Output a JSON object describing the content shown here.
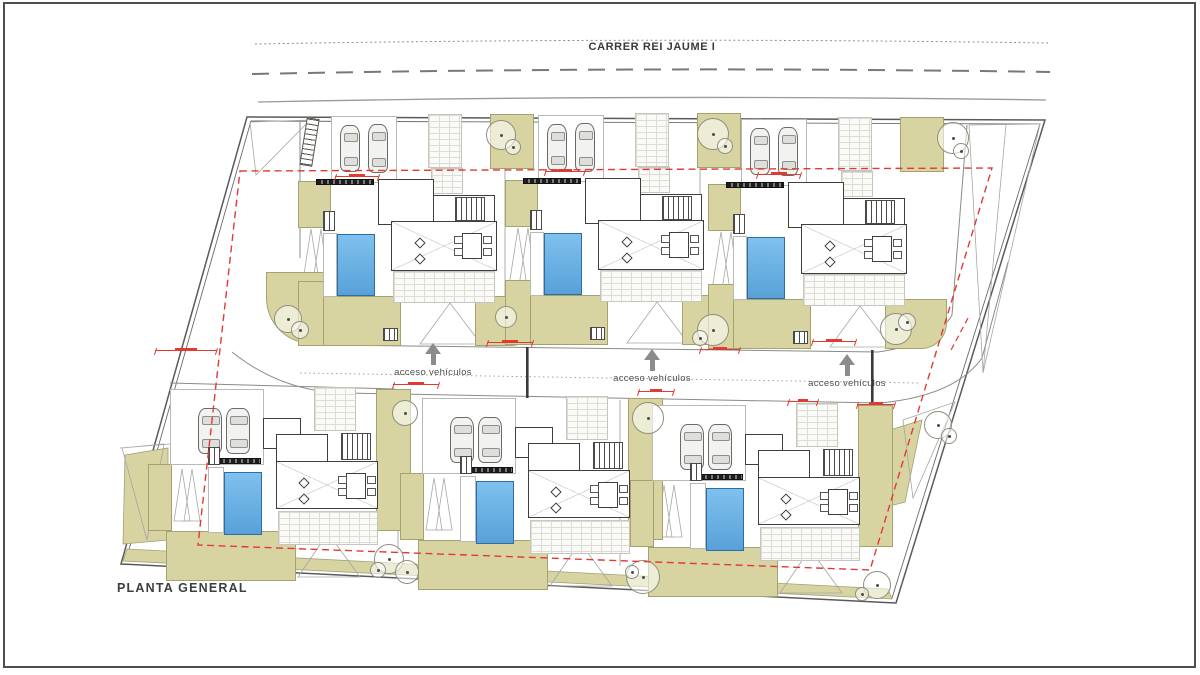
{
  "title_block": {
    "street_name": "CARRER REI JAUME I",
    "plan_title": "PLANTA GENERAL"
  },
  "road": {
    "access_label": "acceso vehículos",
    "arrows": [
      {
        "x": 433,
        "y": 343
      },
      {
        "x": 652,
        "y": 349
      },
      {
        "x": 847,
        "y": 354
      }
    ]
  },
  "houses": [
    {
      "id": "villa-1",
      "variant": "top",
      "x": 298,
      "y": 111
    },
    {
      "id": "villa-2",
      "variant": "top",
      "x": 505,
      "y": 110
    },
    {
      "id": "villa-3",
      "variant": "top",
      "x": 708,
      "y": 114
    },
    {
      "id": "villa-4",
      "variant": "bottom",
      "x": 148,
      "y": 381
    },
    {
      "id": "villa-5",
      "variant": "bottom",
      "x": 400,
      "y": 390
    },
    {
      "id": "villa-6",
      "variant": "bottom",
      "x": 630,
      "y": 397
    }
  ],
  "trees": [
    {
      "x": 500,
      "y": 134,
      "r": 14
    },
    {
      "x": 512,
      "y": 146,
      "r": 7
    },
    {
      "x": 712,
      "y": 133,
      "r": 15
    },
    {
      "x": 724,
      "y": 145,
      "r": 7
    },
    {
      "x": 952,
      "y": 137,
      "r": 15
    },
    {
      "x": 960,
      "y": 150,
      "r": 7
    },
    {
      "x": 287,
      "y": 318,
      "r": 13
    },
    {
      "x": 299,
      "y": 329,
      "r": 8
    },
    {
      "x": 505,
      "y": 316,
      "r": 10
    },
    {
      "x": 712,
      "y": 329,
      "r": 15
    },
    {
      "x": 699,
      "y": 337,
      "r": 7
    },
    {
      "x": 895,
      "y": 328,
      "r": 15
    },
    {
      "x": 906,
      "y": 321,
      "r": 8
    },
    {
      "x": 404,
      "y": 412,
      "r": 12
    },
    {
      "x": 647,
      "y": 417,
      "r": 15
    },
    {
      "x": 937,
      "y": 424,
      "r": 13
    },
    {
      "x": 948,
      "y": 435,
      "r": 7
    },
    {
      "x": 388,
      "y": 558,
      "r": 14
    },
    {
      "x": 377,
      "y": 569,
      "r": 7
    },
    {
      "x": 406,
      "y": 571,
      "r": 11
    },
    {
      "x": 642,
      "y": 576,
      "r": 16
    },
    {
      "x": 631,
      "y": 571,
      "r": 6
    },
    {
      "x": 876,
      "y": 584,
      "r": 13
    },
    {
      "x": 861,
      "y": 593,
      "r": 6
    }
  ],
  "dimension_marks": [
    {
      "x": 335,
      "y": 176,
      "w": 44
    },
    {
      "x": 545,
      "y": 171,
      "w": 40
    },
    {
      "x": 757,
      "y": 174,
      "w": 44
    },
    {
      "x": 487,
      "y": 342,
      "w": 46
    },
    {
      "x": 700,
      "y": 349,
      "w": 40
    },
    {
      "x": 812,
      "y": 341,
      "w": 44
    },
    {
      "x": 155,
      "y": 350,
      "w": 62
    },
    {
      "x": 393,
      "y": 384,
      "w": 46
    },
    {
      "x": 638,
      "y": 391,
      "w": 36
    },
    {
      "x": 788,
      "y": 401,
      "w": 30
    },
    {
      "x": 857,
      "y": 404,
      "w": 38
    }
  ],
  "colors": {
    "lawn_green": "#d7d4a2",
    "pool_blue": "#6cb1e4",
    "setback_red": "#e03b33",
    "line_dark": "#4f4f4f",
    "line_mid": "#8a8a86",
    "arrow_gray": "#8c8c8c"
  },
  "icons": {
    "car": "car-icon",
    "tree": "tree-icon",
    "access_arrow": "access-arrow-icon",
    "stepping_stone": "stepping-stone",
    "dimension": "dimension-annotation"
  }
}
